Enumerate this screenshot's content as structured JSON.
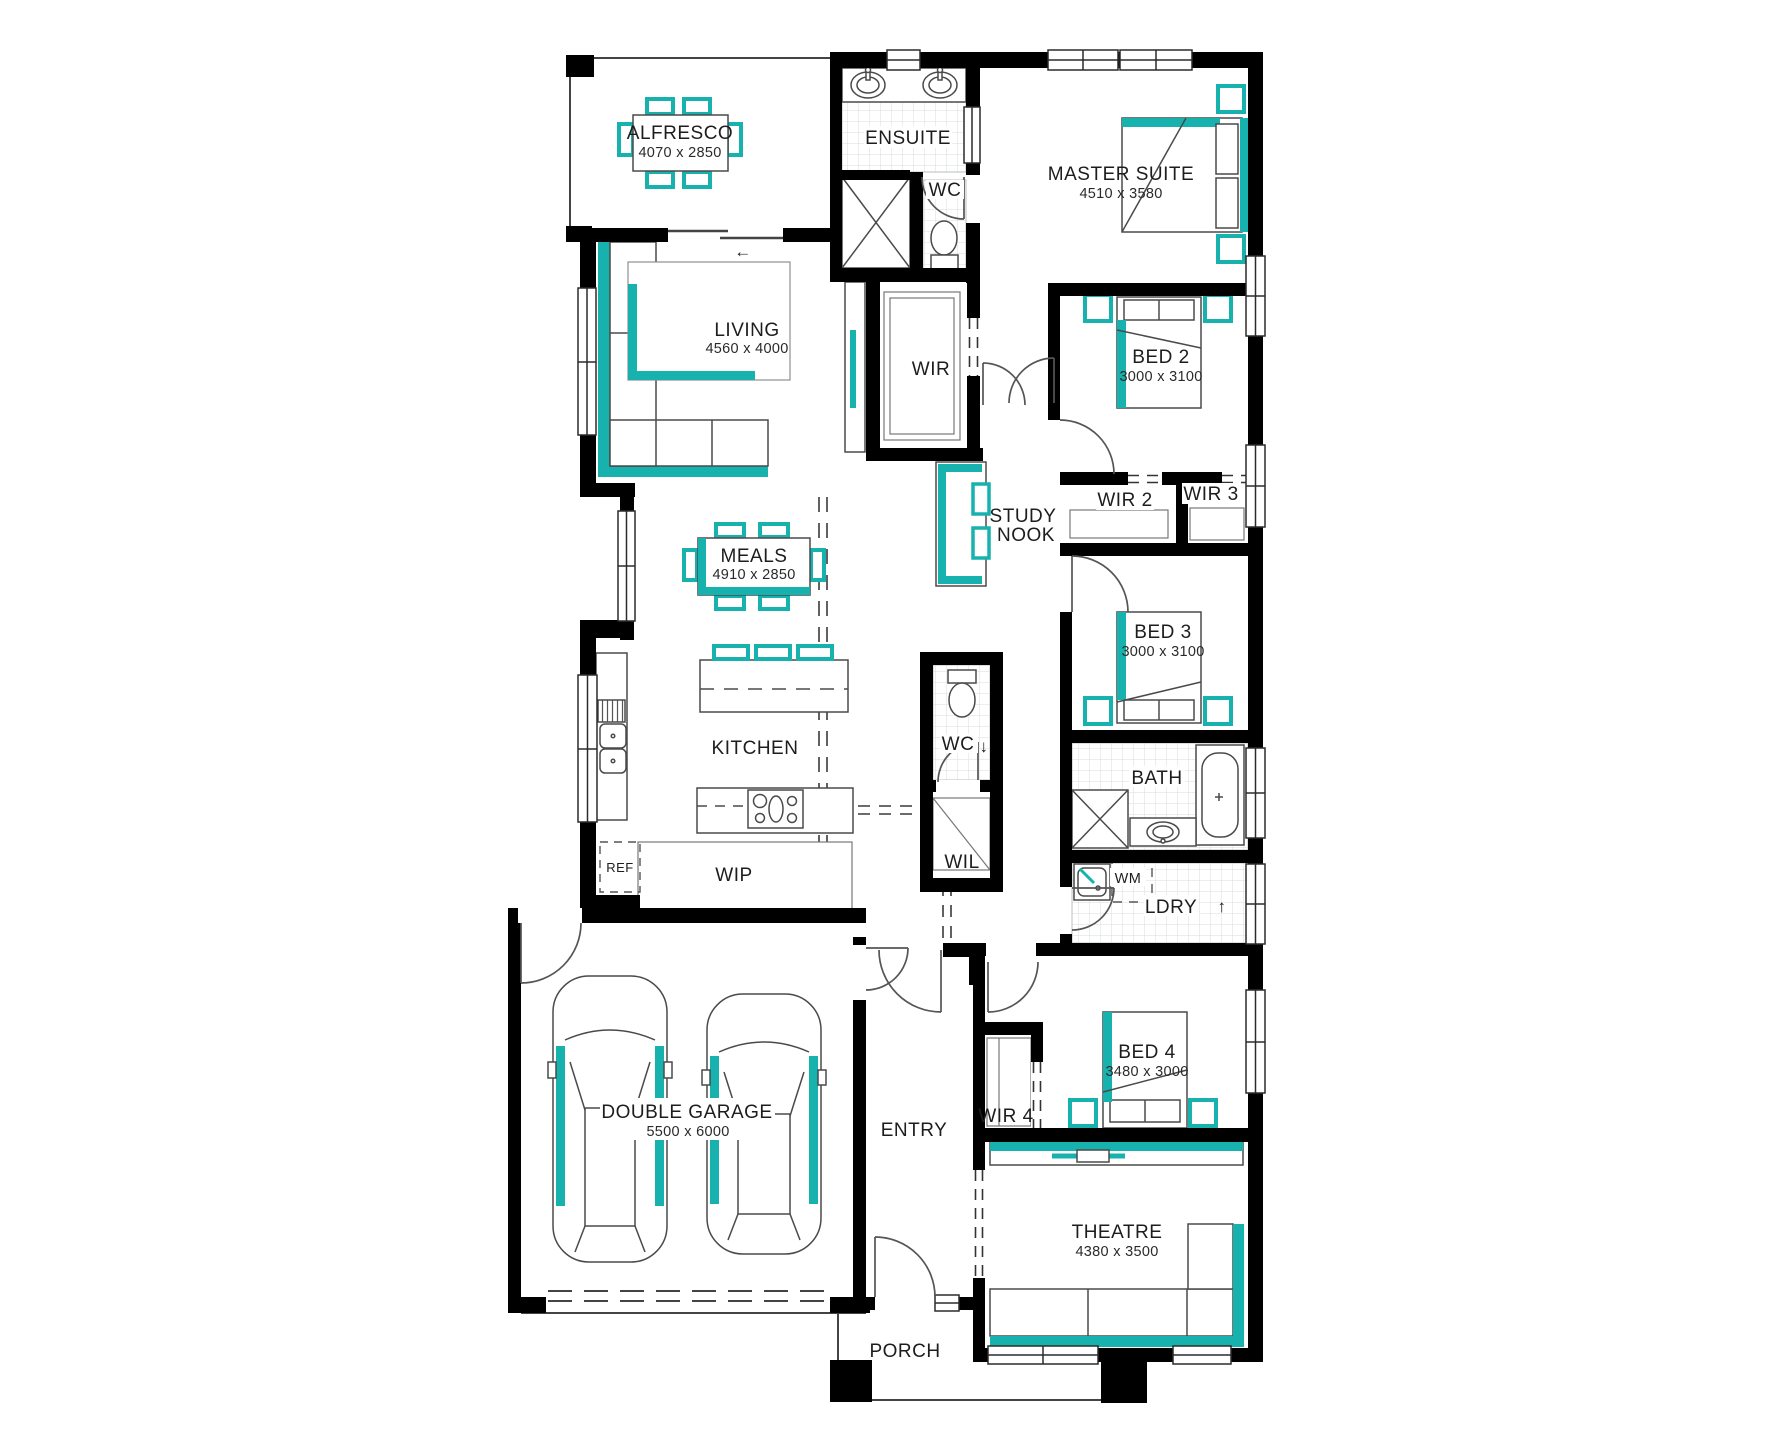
{
  "colors": {
    "accent": "#17b2ad",
    "wall": "#000000"
  },
  "rooms": {
    "alfresco": {
      "label": "ALFRESCO",
      "dims": "4070 x 2850"
    },
    "ensuite": {
      "label": "ENSUITE"
    },
    "wc_ensuite": {
      "label": "WC"
    },
    "master": {
      "label": "MASTER SUITE",
      "dims": "4510 x 3580"
    },
    "living": {
      "label": "LIVING",
      "dims": "4560 x 4000"
    },
    "wir": {
      "label": "WIR"
    },
    "bed2": {
      "label": "BED 2",
      "dims": "3000 x 3100"
    },
    "study_nook": {
      "line1": "STUDY",
      "line2": "NOOK"
    },
    "wir2": {
      "label": "WIR 2"
    },
    "wir3": {
      "label": "WIR 3"
    },
    "meals": {
      "label": "MEALS",
      "dims": "4910 x 2850"
    },
    "bed3": {
      "label": "BED 3",
      "dims": "3000 x 3100"
    },
    "kitchen": {
      "label": "KITCHEN"
    },
    "wc_hall": {
      "label": "WC"
    },
    "wil": {
      "label": "WIL"
    },
    "bath": {
      "label": "BATH"
    },
    "ref": {
      "label": "REF"
    },
    "wip": {
      "label": "WIP"
    },
    "wm": {
      "label": "WM"
    },
    "ldry": {
      "label": "LDRY"
    },
    "garage": {
      "label": "DOUBLE GARAGE",
      "dims": "5500 x 6000"
    },
    "entry": {
      "label": "ENTRY"
    },
    "wir4": {
      "label": "WIR 4"
    },
    "bed4": {
      "label": "BED 4",
      "dims": "3480 x 3000"
    },
    "theatre": {
      "label": "THEATRE",
      "dims": "4380 x 3500"
    },
    "porch": {
      "label": "PORCH"
    }
  },
  "symbols": {
    "slider_arrow": "←",
    "laundry_exit_arrow": "↑",
    "wc_arrow": "↓"
  }
}
